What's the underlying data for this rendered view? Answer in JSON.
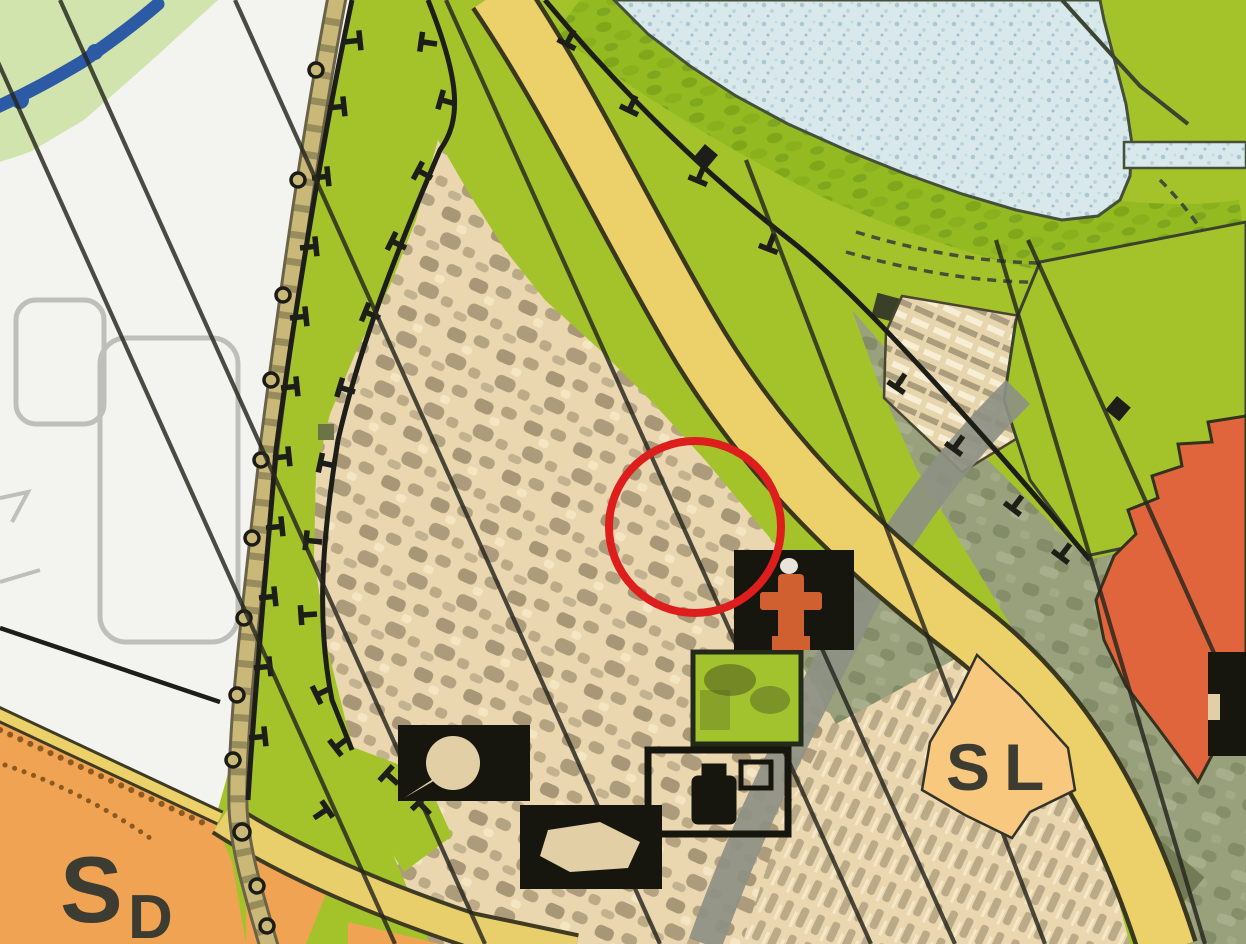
{
  "page": {
    "title": "Urban zoning plan map detail with highlighted location"
  },
  "labels": {
    "sd": {
      "main": "S",
      "sub": "D"
    },
    "sl": {
      "first": "S",
      "second": "L"
    }
  },
  "annotation": {
    "shape": "circle",
    "purpose": "highlighted-location",
    "color": "#de1d1d"
  },
  "colors": {
    "parkland_green": "#a4c32b",
    "shore_green": "#94ba22",
    "pale_green": "#d2e4ae",
    "water_fill": "#d9e8ea",
    "water_speckle": "#a9c9d2",
    "stream_blue": "#2d5aa4",
    "urban_beige": "#ead7b0",
    "urban_mottle": "#6f6248",
    "olive_zone": "#99a07c",
    "olive_dark": "#6d7751",
    "zone_white": "#f3f3f0",
    "zone_orange": "#f0a352",
    "zone_peach": "#f8c87e",
    "zone_red": "#e0653c",
    "road_yellow": "#ecd06a",
    "road_tan": "#c9b878",
    "road_gray": "#8d9083",
    "line_dark": "#26261e",
    "boundary_dark": "#1e1e18",
    "symbol_black": "#16160f",
    "church_orange": "#d06030",
    "park_green": "#a2c22e",
    "circle_red": "#de1d1d",
    "label_dark": "#3c3c32",
    "street_gray": "#bfbfba"
  },
  "features": {
    "water": [
      "lake-speckled",
      "stream",
      "lake-outlet-channel"
    ],
    "roads": [
      "main-yellow-road",
      "lower-yellow-road",
      "orange-edge-road",
      "tan-track-with-poles",
      "gray-road"
    ],
    "zones": [
      "parkland",
      "urban-core",
      "olive-mixed-zone",
      "white-development-zone",
      "orange-special-zone-SD",
      "peach-special-zone-SL",
      "red-zone",
      "checkered-block",
      "park-square"
    ],
    "overlays": [
      "overhead-utility-lines",
      "boundary-lines-with-tick-marks",
      "dashed-shore-paths",
      "dotted-zone-border"
    ],
    "symbols": [
      "monument-circle-symbol",
      "monument-oval-symbol",
      "memorial-outline-symbol",
      "church-symbol",
      "edge-monument-symbol"
    ]
  }
}
